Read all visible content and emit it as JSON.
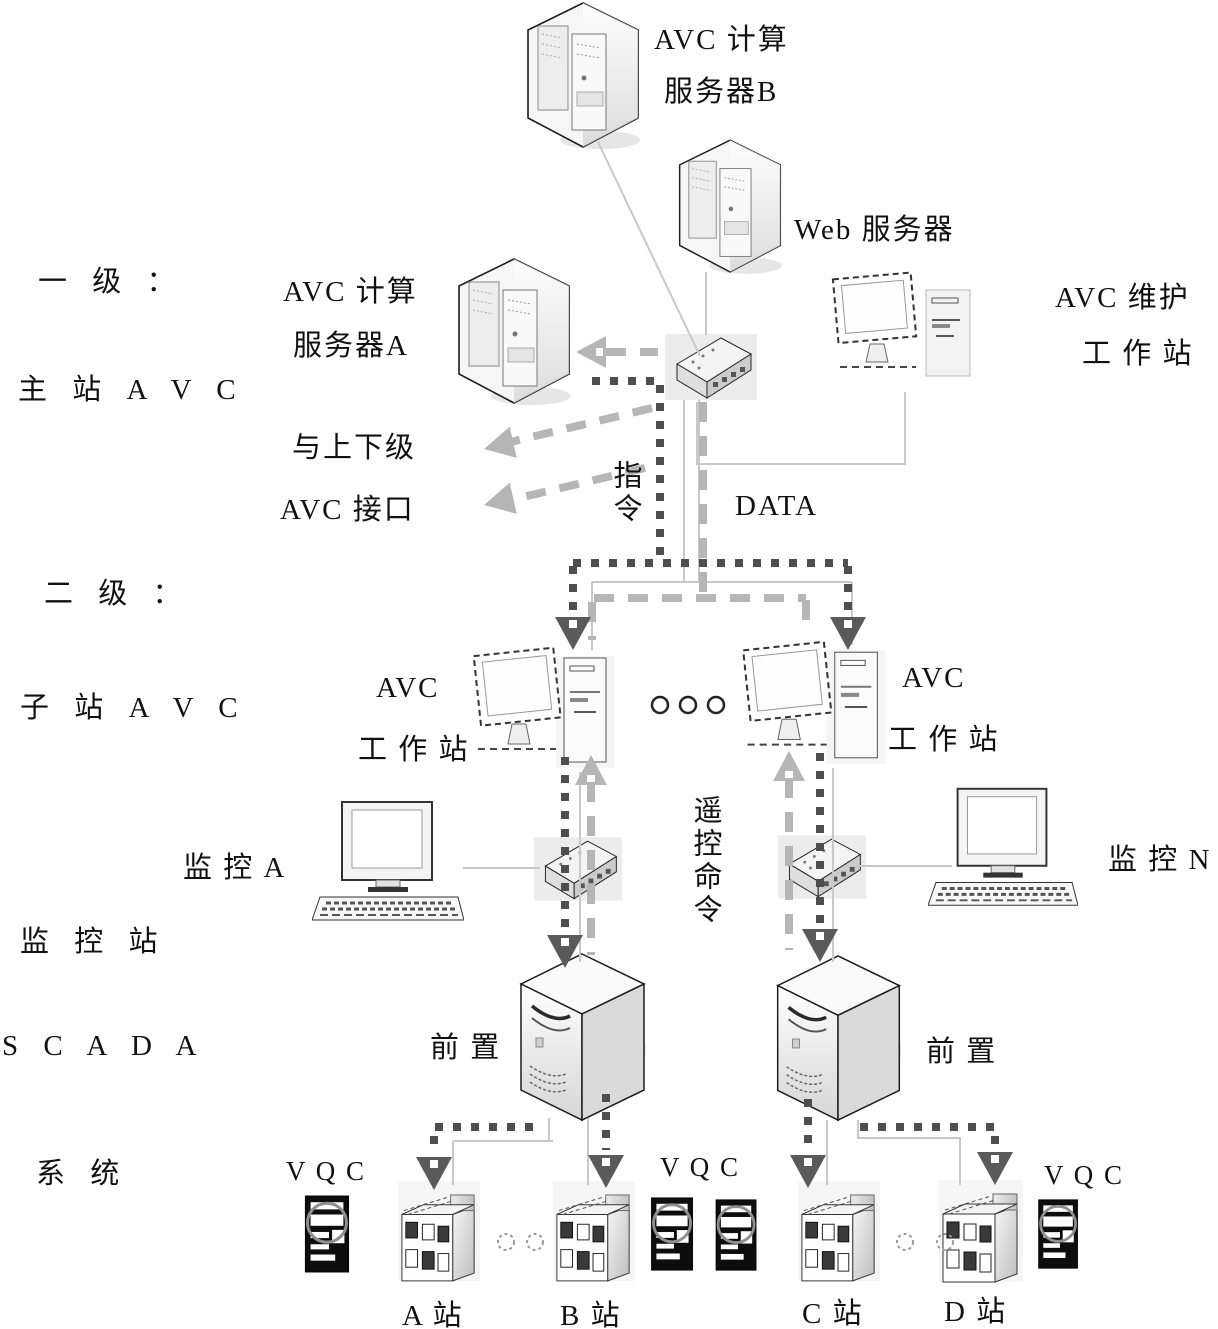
{
  "palette": {
    "background": "#ffffff",
    "text": "#111111",
    "command_flow_dark": "#4e4e4e",
    "data_flow_gray": "#b6b6b6",
    "network_line": "#c8c8c8",
    "device_outline": "#1c1c1c",
    "vqc_body": "#0d0d0d"
  },
  "icons": {
    "server": "server-tower-icon",
    "front_end": "front-server-icon",
    "hub": "network-hub-icon",
    "workstation": "monitor-tower-icon",
    "desktop": "desktop-pc-icon",
    "building": "station-building-icon",
    "vqc": "vqc-cabinet-icon"
  },
  "levels": {
    "level1": {
      "title": "一 级 ：",
      "subtitle": "主 站 A V C"
    },
    "level2": {
      "title": "二 级 ：",
      "subtitle": "子 站 A V C"
    },
    "monitor_station": "监 控 站",
    "scada_line1": "S C A D A",
    "scada_line2": "系 统"
  },
  "nodes": {
    "server_b": {
      "line1": "AVC 计算",
      "line2": "服务器B"
    },
    "web_server": {
      "label": "Web 服务器"
    },
    "server_a": {
      "line1": "AVC 计算",
      "line2": "服务器A"
    },
    "maintenance_ws": {
      "line1": "AVC 维护",
      "line2": "工 作 站"
    },
    "left_ws": {
      "line1": "AVC",
      "line2": "工 作 站"
    },
    "right_ws": {
      "line1": "AVC",
      "line2": "工 作 站"
    },
    "monitor_a": {
      "label": "监 控 A"
    },
    "monitor_n": {
      "label": "监 控 N"
    },
    "front_left": {
      "label": "前 置"
    },
    "front_right": {
      "label": "前 置"
    },
    "vqc_left": {
      "label": "V Q C"
    },
    "vqc_mid": {
      "label": "V Q C"
    },
    "vqc_right": {
      "label": "V Q C"
    },
    "station_a": {
      "label": "A 站"
    },
    "station_b": {
      "label": "B 站"
    },
    "station_c": {
      "label": "C 站"
    },
    "station_d": {
      "label": "D 站"
    }
  },
  "flows": {
    "interface_line1": "与上下级",
    "interface_line2": "AVC 接口",
    "command": "指令",
    "data": "DATA",
    "remote_command": "遥控命令"
  }
}
